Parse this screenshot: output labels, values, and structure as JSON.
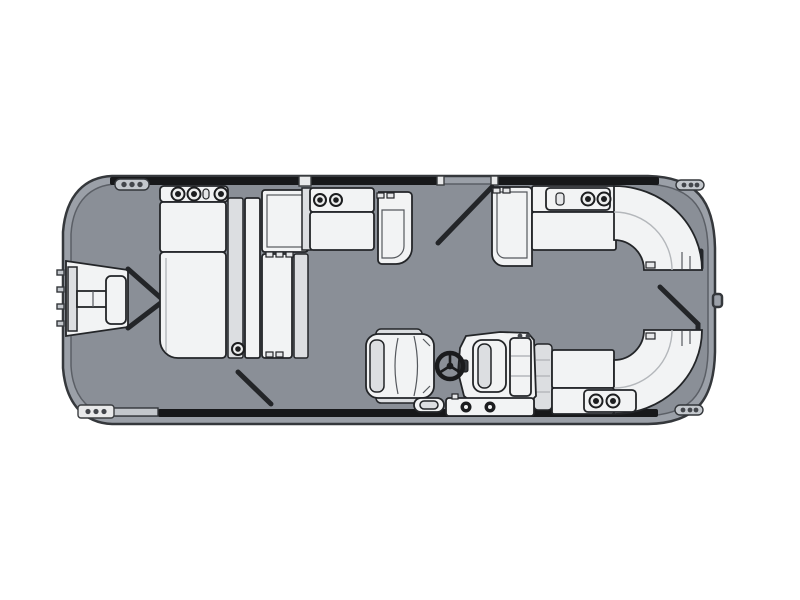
{
  "meta": {
    "description": "Top-down floor plan diagram of a pontoon boat with bow boarding platform, bow chaise lounge group, midship bench, helm console with captain's chair, and twin wraparound stern lounges",
    "view": "overhead floor plan",
    "orientation": "bow at left, stern at right"
  },
  "colors": {
    "background": "#ffffff",
    "hull_rim": "#9ba0a8",
    "deck": "#8a8f97",
    "outline": "#35383c",
    "rail": "#17181a",
    "upholstery": "#f2f3f4",
    "upholstery_shade": "#dcdee1",
    "hardware": "#c3c7cc",
    "wheel": "#1a1b1d"
  },
  "elements": [
    {
      "label": "Pontoon hull with rounded stern corners"
    },
    {
      "label": "Main deck surface"
    },
    {
      "label": "Bow boarding platform with ladder and step pad"
    },
    {
      "label": "Bow fence converging to center gate"
    },
    {
      "label": "Bow chaise lounge group with armrest cupholders"
    },
    {
      "label": "Midship bench seat with cupholders and rounded arm"
    },
    {
      "label": "Port side gate swing mark (top)"
    },
    {
      "label": "Starboard stern wraparound lounge (top)"
    },
    {
      "label": "Port stern wraparound lounge (bottom)"
    },
    {
      "label": "Captain's swivel chair"
    },
    {
      "label": "Helm console with windscreen"
    },
    {
      "label": "Steering wheel"
    },
    {
      "label": "Helm boarding step with latches"
    },
    {
      "label": "Stern gate swing mark"
    },
    {
      "label": "Aft side gate swing mark (bottom)"
    },
    {
      "label": "Corner cleat with three pins"
    }
  ]
}
